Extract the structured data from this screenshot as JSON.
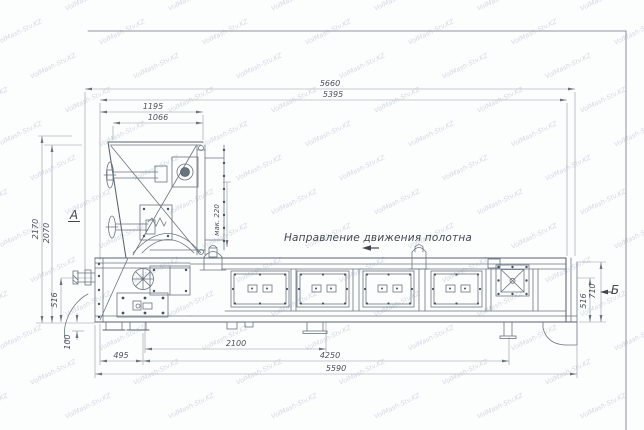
{
  "watermark": {
    "text": "VolMash-Stv.KZ"
  },
  "annotations": {
    "direction_label": "Направление движения полотна",
    "view_a": "А",
    "view_b": "Б",
    "max_gap": "мак. 220"
  },
  "dim": {
    "top_overall": "5660",
    "top_second": "5395",
    "top_head_outer": "1195",
    "top_head_inner": "1066",
    "left_total_height": "2170",
    "left_body_height": "2070",
    "left_frame_height": "516",
    "left_foot_height": "100",
    "right_total_height": "710",
    "right_frame_height": "516",
    "bottom_first": "495",
    "bottom_drive": "2100",
    "bottom_span": "4250",
    "bottom_overall": "5590"
  }
}
